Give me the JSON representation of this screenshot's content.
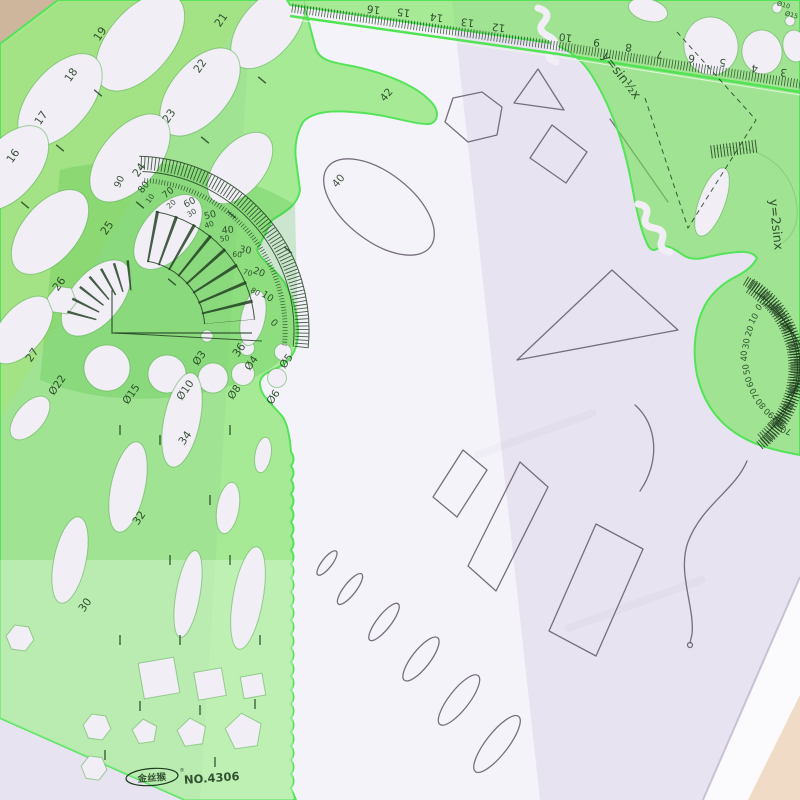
{
  "left_template": {
    "ellipse_size_labels": [
      "16",
      "17",
      "18",
      "19",
      "21",
      "22",
      "23",
      "24",
      "25",
      "26",
      "27"
    ],
    "column_ellipse_labels": [
      "30",
      "32",
      "34",
      "36"
    ],
    "curve_labels": [
      "40",
      "42"
    ],
    "circle_diameter_labels": [
      "Ø22",
      "Ø15",
      "Ø10",
      "Ø8",
      "Ø6",
      "Ø3",
      "Ø4",
      "Ø5"
    ],
    "protractor_outer_degree_labels": [
      "90",
      "80",
      "70",
      "60",
      "50",
      "40",
      "30",
      "20",
      "10",
      "0"
    ],
    "protractor_inner_degree_labels": [
      "10",
      "20",
      "30",
      "40",
      "50",
      "60",
      "70",
      "80"
    ],
    "brand": {
      "logo_text": "金丝猴",
      "registered_mark": "®",
      "model_number": "NO.4306"
    }
  },
  "right_template": {
    "ruler_scale_labels": [
      "16",
      "15",
      "14",
      "13",
      "12",
      "10",
      "9",
      "8",
      "7",
      "6",
      "5",
      "4",
      "3"
    ],
    "function_curve_labels": [
      "y=sin½x",
      "y=2sinx"
    ],
    "small_diameter_labels": [
      "Ø10",
      "Ø15"
    ],
    "protractor_degree_labels": [
      "0",
      "10",
      "20",
      "30",
      "40",
      "50",
      "60",
      "70",
      "80",
      "90",
      "80",
      "70"
    ]
  },
  "colors": {
    "table": "#efdfd2",
    "table-corner": "#cdb69b",
    "paper-white": "#fbfafd",
    "paper-lavender": "#e8e3f1",
    "paper-band": "#f7f5fb",
    "pencil": "#6b6472",
    "template-green": "rgba(108,228,78,0.58)",
    "template-edge": "#55e35a",
    "engraving": "#1e3c1e",
    "cutout": "#f1eef6"
  }
}
